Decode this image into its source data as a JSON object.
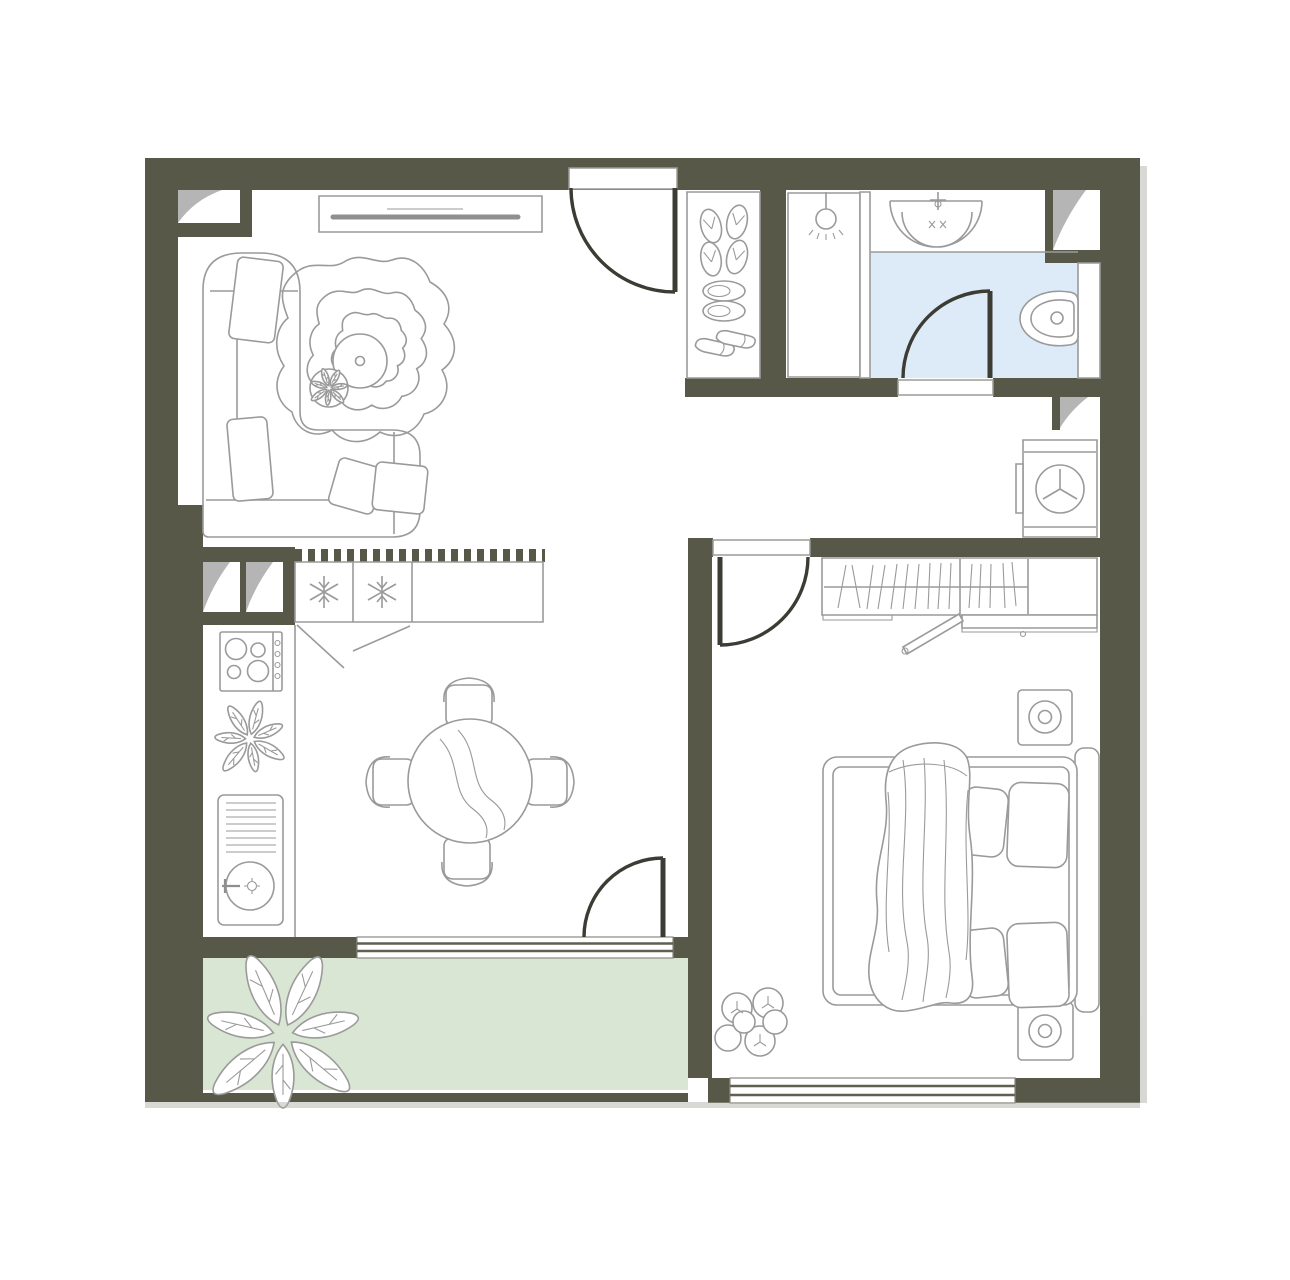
{
  "title": "One-bedroom apartment floor plan (top-down architectural drawing, no text labels)",
  "colors": {
    "wall": "#585849",
    "door": "#3c3c35",
    "line": "#9a9a9a",
    "bathroom_floor": "#dcebf7",
    "balcony_floor": "#d9e6d3",
    "vent": "#b5b5b5",
    "shadow": "#a8a8a0"
  },
  "rooms": [
    {
      "name": "living-room",
      "items": [
        "tv-console",
        "corner-sofa",
        "sofa-cushions",
        "wavy-rug",
        "round-coffee-table",
        "side-table-plant",
        "ventilation-shaft"
      ]
    },
    {
      "name": "entrance-hall",
      "items": [
        "entrance-door",
        "shoe-cabinet",
        "flip-flops",
        "slippers",
        "shoes"
      ]
    },
    {
      "name": "bathroom",
      "items": [
        "shower-zone",
        "pendant-light",
        "glass-partition",
        "washbasin",
        "faucet",
        "toilet",
        "door",
        "ventilation-shaft",
        "light-blue-floor"
      ]
    },
    {
      "name": "utility-niche",
      "items": [
        "washing-machine",
        "ventilation-shaft"
      ]
    },
    {
      "name": "kitchen-dining",
      "items": [
        "fridge-freezer-counter",
        "snowflake-symbols",
        "tiled-backsplash-strip",
        "stove-4-burners",
        "potted-plant",
        "sink-with-drainboard",
        "round-dining-table",
        "four-chairs",
        "balcony-door"
      ]
    },
    {
      "name": "bedroom",
      "items": [
        "door",
        "wardrobe-with-clothes",
        "open-sliding-door",
        "dresser-shelf",
        "nightstand",
        "nightstand",
        "double-bed",
        "pillows",
        "draped-blanket",
        "floor-plant",
        "window"
      ]
    },
    {
      "name": "balcony",
      "items": [
        "green-floor",
        "large-plant",
        "railing",
        "window-to-kitchen"
      ]
    }
  ]
}
